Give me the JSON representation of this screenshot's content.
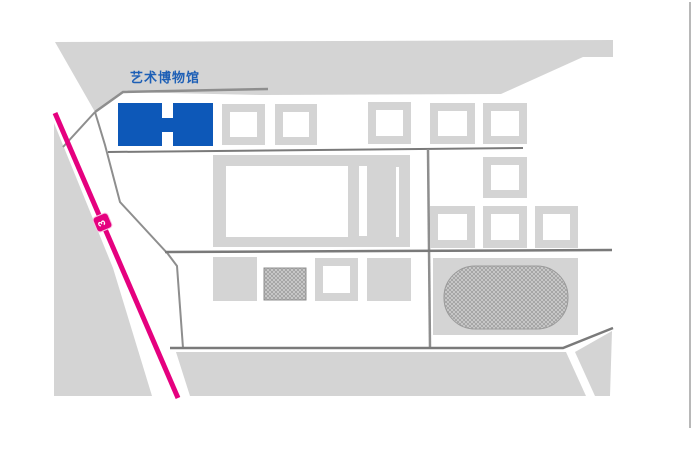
{
  "page": {
    "width": 692,
    "height": 463,
    "background": "#FFFFFF"
  },
  "map": {
    "poi_label": {
      "text": "艺术博物馆",
      "color": "#1D5FB6",
      "x": 130,
      "y": 71,
      "font_size": 13
    },
    "metro_line": {
      "name": "metro-line",
      "color": "#E5017F",
      "width": 5,
      "from": [
        55,
        113
      ],
      "to": [
        178,
        398
      ]
    },
    "station": {
      "label": "3",
      "color": "#E5017F",
      "text_color": "#FFFFFF",
      "cx": 102,
      "cy": 222,
      "size": 17,
      "angle_deg": -23
    },
    "palette": {
      "block": "#D4D4D4",
      "road": "#8E8E8E",
      "road_dark": "#7A7A7A",
      "museum_blue": "#0D58B8",
      "hatch_base": "#CDCDCD",
      "hatch_line": "#8F8F8F",
      "map_border": "#B8B8B8"
    },
    "terrain": [
      {
        "name": "north-block",
        "kind": "poly",
        "fill": "#D4D4D4",
        "points": [
          [
            55,
            42
          ],
          [
            613,
            40
          ],
          [
            613,
            57
          ],
          [
            583,
            57
          ],
          [
            501,
            94
          ],
          [
            262,
            95
          ],
          [
            123,
            92
          ],
          [
            95,
            112
          ]
        ]
      },
      {
        "name": "west-wedge-block",
        "kind": "poly",
        "fill": "#D4D4D4",
        "points": [
          [
            54,
            123
          ],
          [
            113,
            268
          ],
          [
            152,
            396
          ],
          [
            54,
            396
          ]
        ]
      },
      {
        "name": "south-block",
        "kind": "poly",
        "fill": "#D4D4D4",
        "points": [
          [
            176,
            352
          ],
          [
            566,
            352
          ],
          [
            586,
            396
          ],
          [
            190,
            396
          ]
        ]
      },
      {
        "name": "south-east-block",
        "kind": "poly",
        "fill": "#D4D4D4",
        "points": [
          [
            575,
            352
          ],
          [
            612,
            331
          ],
          [
            610,
            396
          ],
          [
            595,
            396
          ]
        ]
      }
    ],
    "roads": [
      {
        "name": "road-access",
        "points": [
          [
            63,
            147
          ],
          [
            95,
            112
          ]
        ],
        "color": "#8E8E8E",
        "w": 2
      },
      {
        "name": "road-museum-top",
        "points": [
          [
            95,
            112
          ],
          [
            123,
            92
          ],
          [
            268,
            89
          ]
        ],
        "color": "#8E8E8E",
        "w": 2.5
      },
      {
        "name": "road-west-curve",
        "points": [
          [
            95,
            112
          ],
          [
            105,
            145
          ],
          [
            120,
            202
          ],
          [
            168,
            254
          ],
          [
            177,
            266
          ],
          [
            183,
            348
          ]
        ],
        "color": "#8E8E8E",
        "w": 2
      },
      {
        "name": "road-mid",
        "points": [
          [
            108,
            152
          ],
          [
            523,
            148
          ]
        ],
        "color": "#7A7A7A",
        "w": 2
      },
      {
        "name": "road-vertical",
        "points": [
          [
            428,
            149
          ],
          [
            430,
            348
          ]
        ],
        "color": "#8E8E8E",
        "w": 2.5
      },
      {
        "name": "road-lower",
        "points": [
          [
            165,
            252
          ],
          [
            612,
            250
          ]
        ],
        "color": "#7A7A7A",
        "w": 2.5
      },
      {
        "name": "road-south",
        "points": [
          [
            170,
            348
          ],
          [
            563,
            348
          ],
          [
            613,
            328
          ]
        ],
        "color": "#7A7A7A",
        "w": 2.5
      },
      {
        "name": "map-east-border",
        "points": [
          [
            690,
            2
          ],
          [
            690,
            428
          ]
        ],
        "color": "#B8B8B8",
        "w": 2
      }
    ],
    "buildings": [
      {
        "name": "art-museum-building",
        "kind": "museum",
        "x": 118,
        "y": 103,
        "w": 95,
        "h": 43,
        "fill": "#0D58B8",
        "notches": [
          [
            162,
            103,
            11,
            15
          ],
          [
            162,
            132,
            11,
            14
          ]
        ],
        "interactable": true
      },
      {
        "name": "hollow-building-1",
        "kind": "hollow",
        "x": 222,
        "y": 104,
        "w": 43,
        "h": 41,
        "t": 8
      },
      {
        "name": "hollow-building-2",
        "kind": "hollow",
        "x": 275,
        "y": 104,
        "w": 42,
        "h": 41,
        "t": 8
      },
      {
        "name": "hollow-building-3",
        "kind": "hollow",
        "x": 368,
        "y": 102,
        "w": 43,
        "h": 42,
        "t": 8
      },
      {
        "name": "hollow-building-4",
        "kind": "hollow",
        "x": 430,
        "y": 103,
        "w": 45,
        "h": 41,
        "t": 8
      },
      {
        "name": "hollow-building-5",
        "kind": "hollow",
        "x": 483,
        "y": 103,
        "w": 44,
        "h": 41,
        "t": 8
      },
      {
        "name": "hollow-building-6",
        "kind": "hollow",
        "x": 483,
        "y": 157,
        "w": 44,
        "h": 41,
        "t": 8
      },
      {
        "name": "hollow-building-7",
        "kind": "hollow",
        "x": 430,
        "y": 206,
        "w": 45,
        "h": 42,
        "t": 8
      },
      {
        "name": "hollow-building-8",
        "kind": "hollow",
        "x": 483,
        "y": 206,
        "w": 44,
        "h": 42,
        "t": 8
      },
      {
        "name": "hollow-building-9",
        "kind": "hollow",
        "x": 535,
        "y": 206,
        "w": 43,
        "h": 42,
        "t": 8
      },
      {
        "name": "hollow-building-10",
        "kind": "hollow",
        "x": 315,
        "y": 258,
        "w": 43,
        "h": 43,
        "t": 8
      },
      {
        "name": "courtyard-building",
        "kind": "compound",
        "x": 213,
        "y": 155,
        "w": 197,
        "h": 92,
        "fill": "#D4D4D4",
        "cuts": [
          [
            226,
            166,
            122,
            71
          ],
          [
            359,
            166,
            8,
            70
          ],
          [
            396,
            167,
            3,
            70
          ]
        ]
      },
      {
        "name": "solid-building-1",
        "kind": "rect",
        "x": 213,
        "y": 257,
        "w": 44,
        "h": 44,
        "fill": "#D4D4D4"
      },
      {
        "name": "solid-building-2",
        "kind": "rect",
        "x": 367,
        "y": 258,
        "w": 44,
        "h": 43,
        "fill": "#D4D4D4"
      },
      {
        "name": "hatched-building",
        "kind": "rect",
        "x": 264,
        "y": 268,
        "w": 42,
        "h": 32,
        "fill": "hatch",
        "stroke": "#8F8F8F"
      },
      {
        "name": "stadium-block",
        "kind": "rect",
        "x": 433,
        "y": 258,
        "w": 145,
        "h": 77,
        "fill": "#D4D4D4"
      },
      {
        "name": "stadium-field",
        "kind": "rect",
        "x": 444,
        "y": 266,
        "w": 124,
        "h": 63,
        "rx": 31,
        "fill": "hatch",
        "stroke": "#9A9A9A"
      }
    ]
  }
}
